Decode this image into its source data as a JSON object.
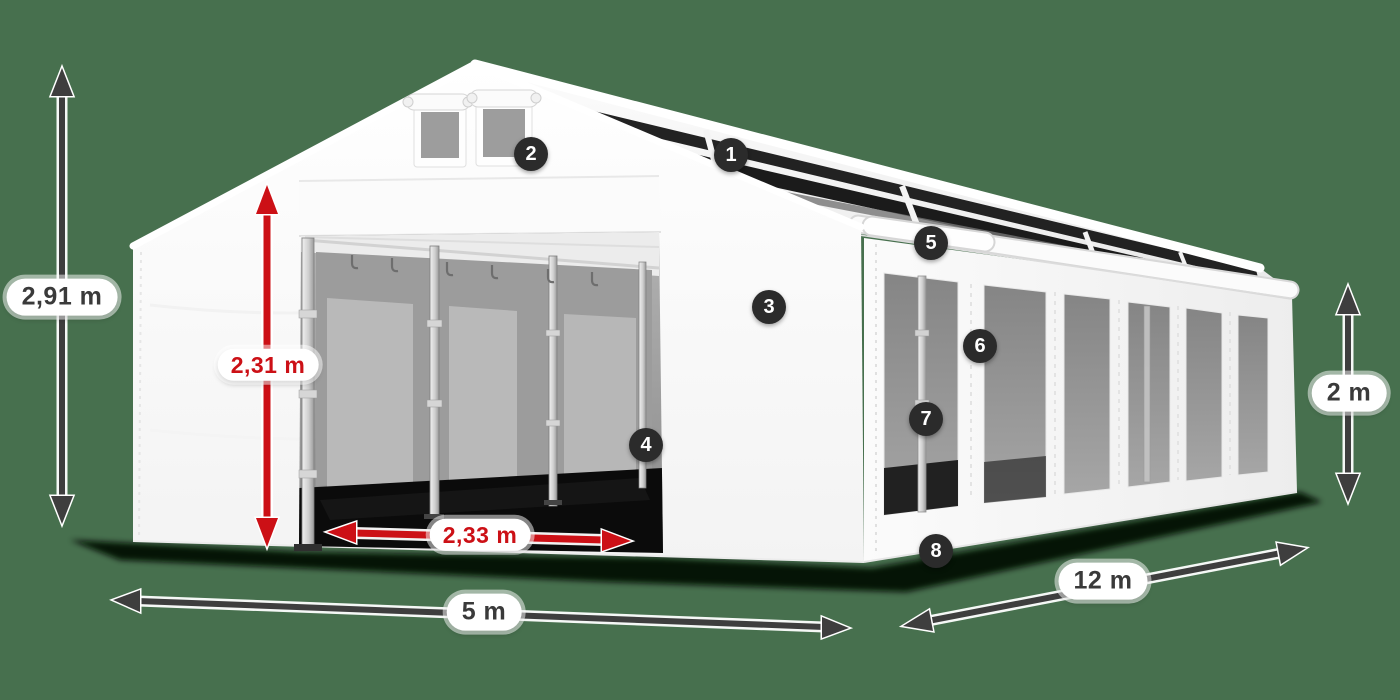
{
  "colors": {
    "background": "#47704e",
    "accent_red": "#cc1016",
    "arrow_dark": "#3e3e3e",
    "badge_bg": "#2b2b2b",
    "badge_text": "#ffffff",
    "label_text": "#3a3a3a",
    "label_bg": "#ffffff",
    "tent_white": "#ffffff",
    "window_gray": "#969696",
    "roof_panel_dark": "#222222"
  },
  "dimensions": {
    "total_height": "2,91 m",
    "door_height": "2,31 m",
    "door_width": "2,33 m",
    "width": "5 m",
    "length": "12 m",
    "side_height": "2 m"
  },
  "badges": [
    {
      "label": "1"
    },
    {
      "label": "2"
    },
    {
      "label": "3"
    },
    {
      "label": "4"
    },
    {
      "label": "5"
    },
    {
      "label": "6"
    },
    {
      "label": "7"
    },
    {
      "label": "8"
    }
  ]
}
